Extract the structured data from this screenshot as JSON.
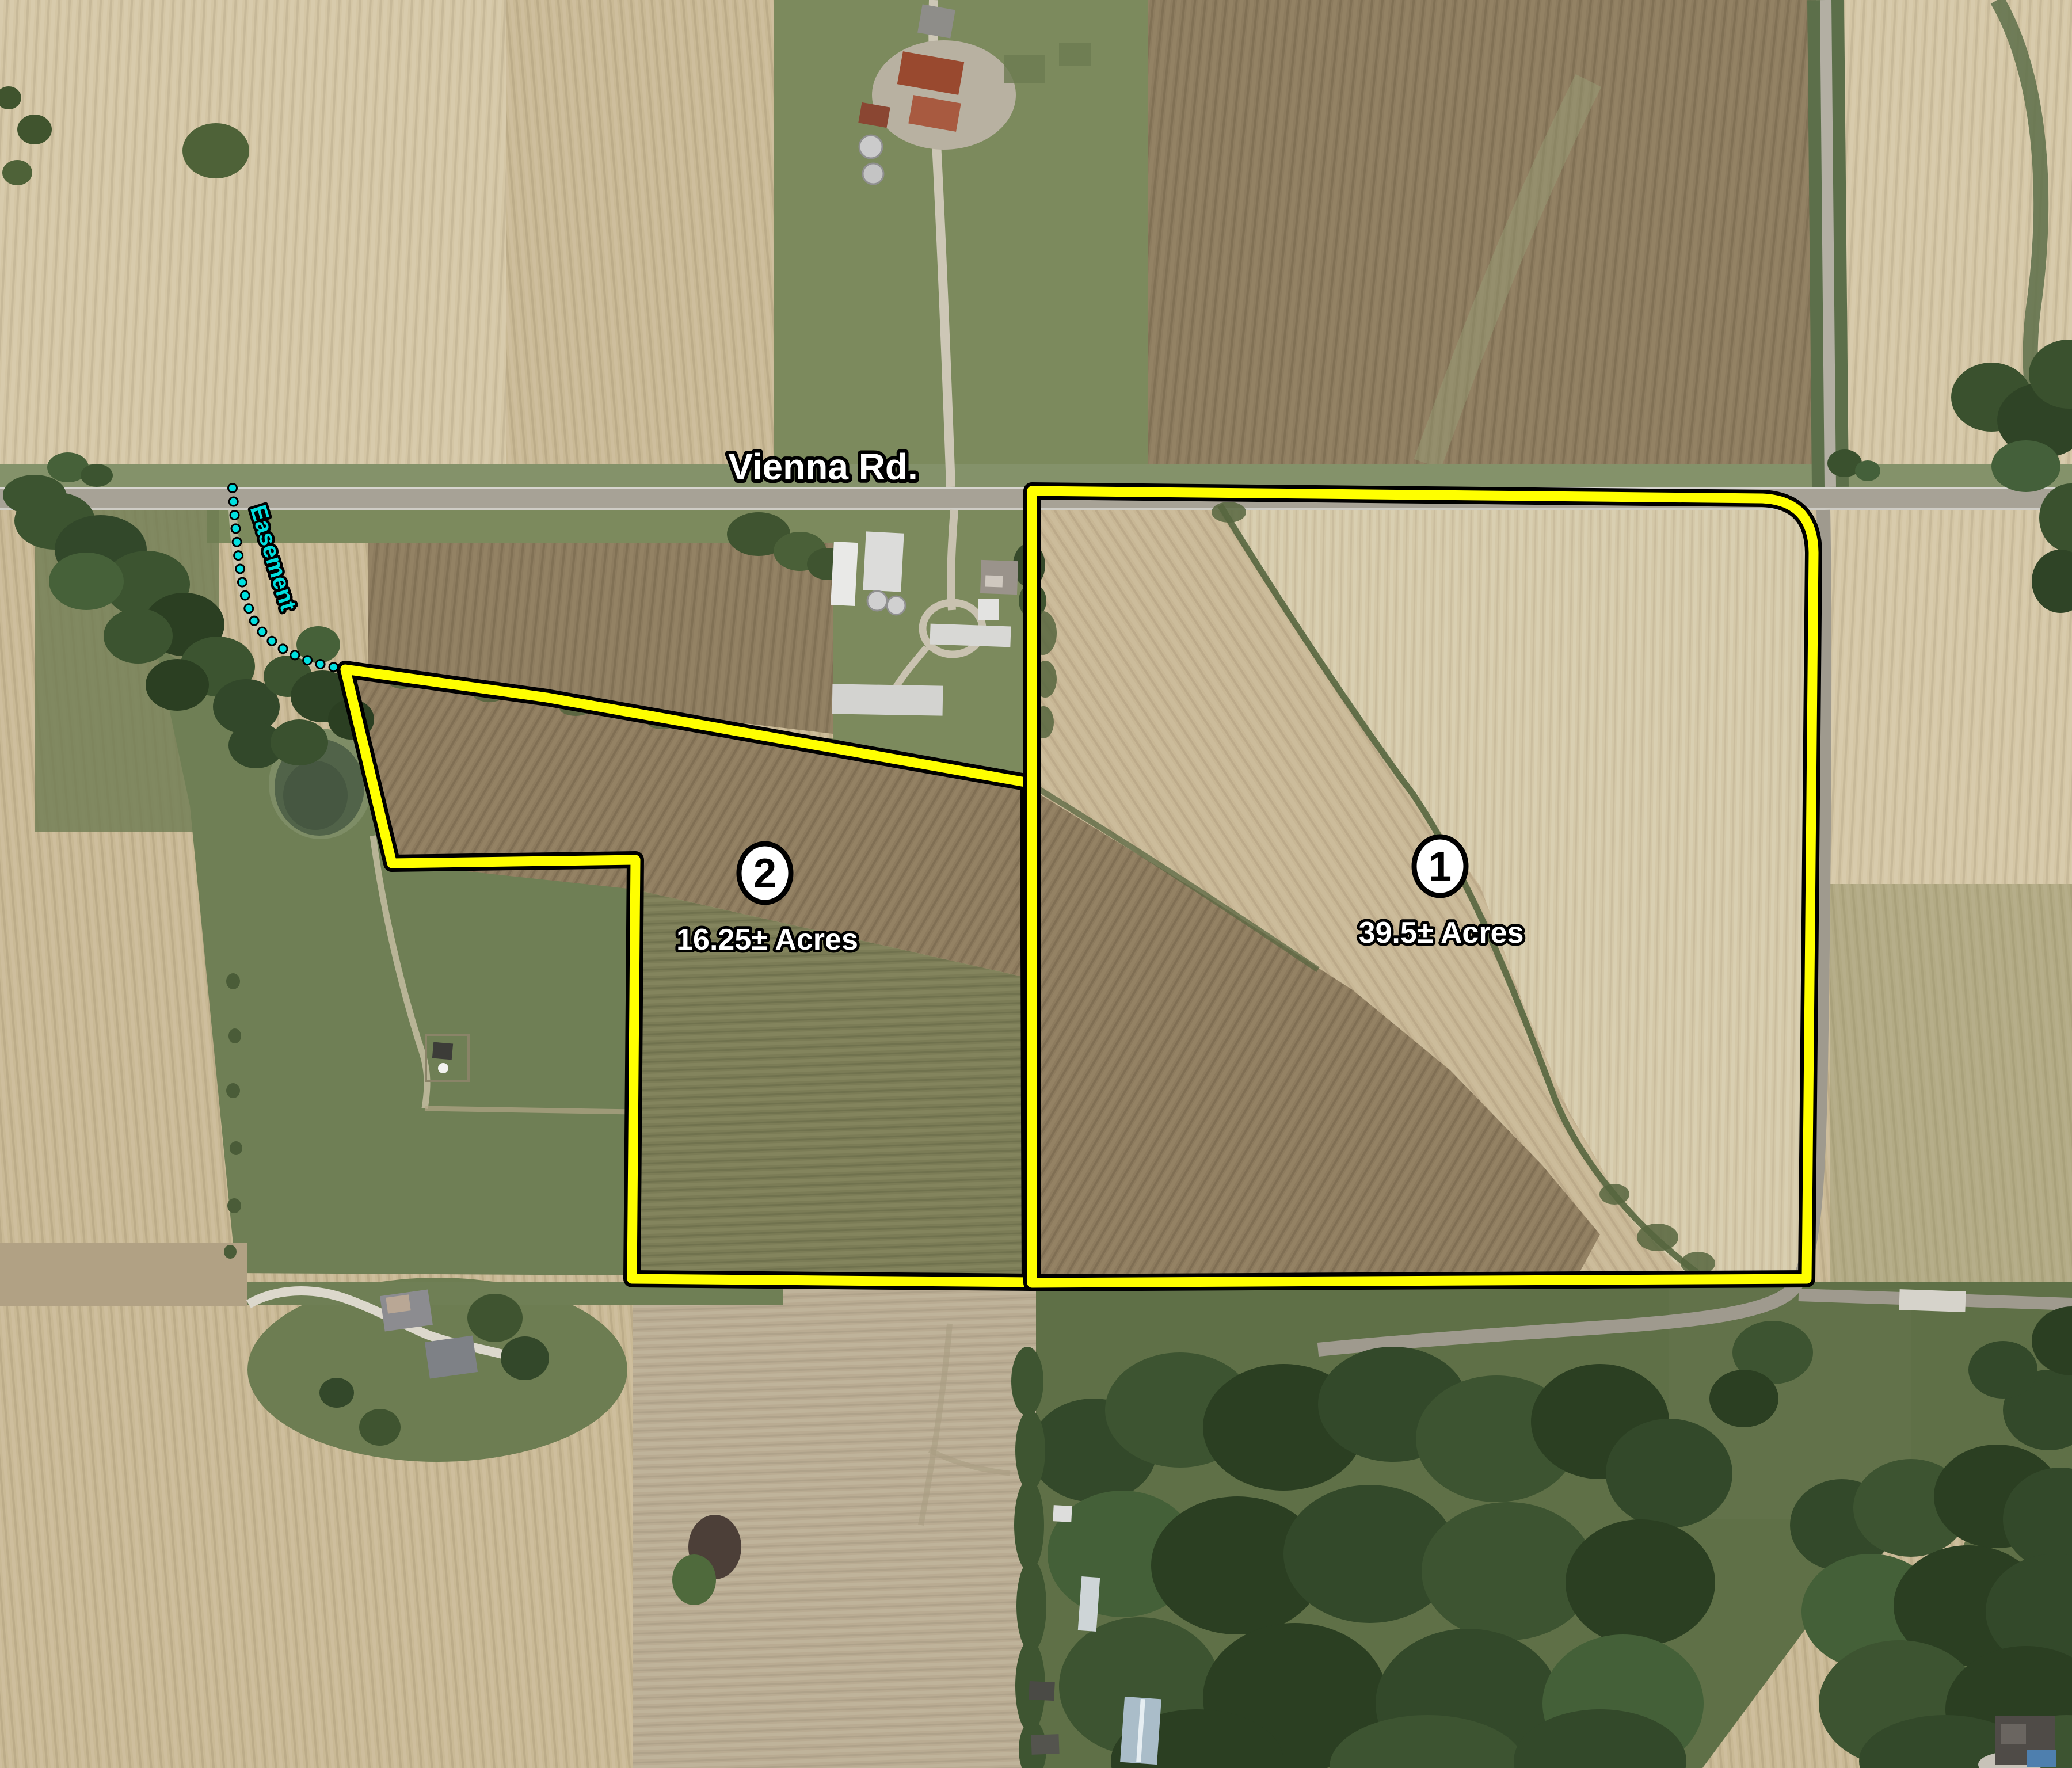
{
  "map": {
    "road_label": "Vienna Rd.",
    "easement_label": "Easement",
    "parcels": [
      {
        "number": "1",
        "acreage": "39.5± Acres"
      },
      {
        "number": "2",
        "acreage": "16.25± Acres"
      }
    ],
    "colors": {
      "parcel_outline": "#ffff00",
      "parcel_casing": "#000000",
      "easement": "#00e0e0",
      "label_fill": "#ffffff",
      "label_outline": "#000000",
      "circle_fill": "#ffffff",
      "circle_number": "#000000"
    }
  }
}
